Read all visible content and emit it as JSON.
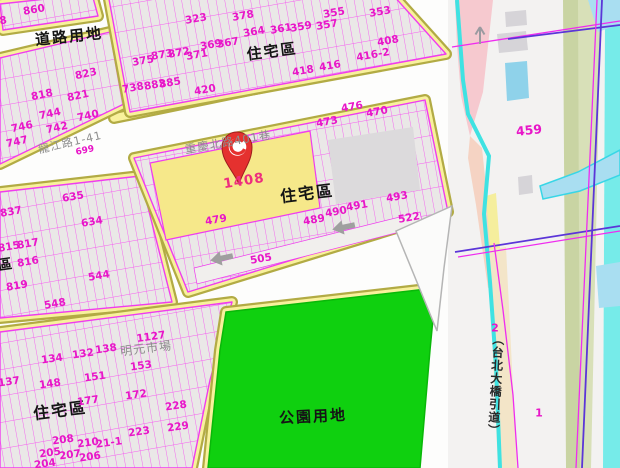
{
  "zones": {
    "road_land": "道路用地",
    "residential": "住宅區",
    "residential_partial": "區",
    "park_land": "公園用地"
  },
  "streets": {
    "lane": "重慶北路401巷",
    "lane2": "龍江路1-41",
    "market": "明元市場",
    "bridge_ramp": "（台北大橋引道）"
  },
  "highlight": {
    "parcel_id": "1408"
  },
  "corridor": {
    "parcel_right": "459",
    "sec2": "2",
    "sec1": "1"
  },
  "colors": {
    "parcel_line": "#f23cf2",
    "road_fill": "#f8f19c",
    "road_edge": "#b2ab44",
    "park": "#0fd00f",
    "highlight_parcel": "#f6e88a",
    "pin": "#e5312f",
    "water": "#3fe2e2",
    "label_magenta": "#e816c8"
  },
  "parcel_numbers": [
    {
      "t": "860",
      "x": 34,
      "y": 10
    },
    {
      "t": "868",
      "x": -4,
      "y": 22
    },
    {
      "t": "823",
      "x": 86,
      "y": 74,
      "r": -12
    },
    {
      "t": "818",
      "x": 42,
      "y": 95,
      "r": -12
    },
    {
      "t": "821",
      "x": 78,
      "y": 96,
      "r": -12
    },
    {
      "t": "744",
      "x": 50,
      "y": 114,
      "r": -12
    },
    {
      "t": "742",
      "x": 57,
      "y": 128,
      "r": -12
    },
    {
      "t": "740",
      "x": 88,
      "y": 116,
      "r": -12
    },
    {
      "t": "746",
      "x": 22,
      "y": 127,
      "r": -12
    },
    {
      "t": "747",
      "x": 17,
      "y": 142,
      "r": -12
    },
    {
      "t": "699",
      "x": 85,
      "y": 151,
      "r": -12,
      "s": 9
    },
    {
      "t": "323",
      "x": 196,
      "y": 19
    },
    {
      "t": "378",
      "x": 243,
      "y": 16
    },
    {
      "t": "355",
      "x": 334,
      "y": 13
    },
    {
      "t": "353",
      "x": 380,
      "y": 12
    },
    {
      "t": "364",
      "x": 254,
      "y": 32
    },
    {
      "t": "361",
      "x": 281,
      "y": 29
    },
    {
      "t": "359",
      "x": 301,
      "y": 27
    },
    {
      "t": "357",
      "x": 327,
      "y": 25
    },
    {
      "t": "369",
      "x": 211,
      "y": 45
    },
    {
      "t": "367",
      "x": 228,
      "y": 43
    },
    {
      "t": "873",
      "x": 162,
      "y": 55
    },
    {
      "t": "872",
      "x": 179,
      "y": 53
    },
    {
      "t": "371",
      "x": 197,
      "y": 55
    },
    {
      "t": "375",
      "x": 143,
      "y": 61
    },
    {
      "t": "408",
      "x": 388,
      "y": 41
    },
    {
      "t": "416-2",
      "x": 373,
      "y": 55
    },
    {
      "t": "418",
      "x": 303,
      "y": 71
    },
    {
      "t": "416",
      "x": 330,
      "y": 66
    },
    {
      "t": "420",
      "x": 205,
      "y": 90
    },
    {
      "t": "738",
      "x": 133,
      "y": 88
    },
    {
      "t": "883",
      "x": 155,
      "y": 85
    },
    {
      "t": "885",
      "x": 170,
      "y": 83
    },
    {
      "t": "473",
      "x": 327,
      "y": 122
    },
    {
      "t": "470",
      "x": 377,
      "y": 112
    },
    {
      "t": "476",
      "x": 352,
      "y": 107
    },
    {
      "t": "479",
      "x": 216,
      "y": 220
    },
    {
      "t": "489",
      "x": 314,
      "y": 220
    },
    {
      "t": "490",
      "x": 336,
      "y": 212
    },
    {
      "t": "491",
      "x": 357,
      "y": 206
    },
    {
      "t": "493",
      "x": 397,
      "y": 197
    },
    {
      "t": "522",
      "x": 409,
      "y": 218
    },
    {
      "t": "505",
      "x": 261,
      "y": 259
    },
    {
      "t": "635",
      "x": 73,
      "y": 197
    },
    {
      "t": "837",
      "x": 11,
      "y": 212
    },
    {
      "t": "634",
      "x": 92,
      "y": 222
    },
    {
      "t": "815",
      "x": 9,
      "y": 247
    },
    {
      "t": "817",
      "x": 28,
      "y": 244
    },
    {
      "t": "816",
      "x": 28,
      "y": 262
    },
    {
      "t": "819",
      "x": 17,
      "y": 286
    },
    {
      "t": "544",
      "x": 99,
      "y": 276
    },
    {
      "t": "548",
      "x": 55,
      "y": 304
    },
    {
      "t": "137",
      "x": 9,
      "y": 382,
      "r": -8
    },
    {
      "t": "134",
      "x": 52,
      "y": 359,
      "r": -8
    },
    {
      "t": "132",
      "x": 83,
      "y": 354,
      "r": -8
    },
    {
      "t": "138",
      "x": 106,
      "y": 349,
      "r": -8
    },
    {
      "t": "1127",
      "x": 151,
      "y": 337,
      "r": -8
    },
    {
      "t": "148",
      "x": 50,
      "y": 384,
      "r": -8
    },
    {
      "t": "151",
      "x": 95,
      "y": 377,
      "r": -8
    },
    {
      "t": "153",
      "x": 141,
      "y": 366,
      "r": -8
    },
    {
      "t": "177",
      "x": 88,
      "y": 401,
      "r": -8
    },
    {
      "t": "172",
      "x": 136,
      "y": 395,
      "r": -8
    },
    {
      "t": "228",
      "x": 176,
      "y": 406,
      "r": -8
    },
    {
      "t": "229",
      "x": 178,
      "y": 427,
      "r": -8
    },
    {
      "t": "223",
      "x": 139,
      "y": 432,
      "r": -8
    },
    {
      "t": "208",
      "x": 63,
      "y": 440,
      "r": -8
    },
    {
      "t": "210",
      "x": 88,
      "y": 443,
      "r": -8
    },
    {
      "t": "21-1",
      "x": 109,
      "y": 443,
      "r": -8
    },
    {
      "t": "205",
      "x": 50,
      "y": 453,
      "r": -8
    },
    {
      "t": "207",
      "x": 70,
      "y": 455,
      "r": -8
    },
    {
      "t": "206",
      "x": 90,
      "y": 457,
      "r": -8
    },
    {
      "t": "204",
      "x": 45,
      "y": 464,
      "r": -8
    }
  ]
}
